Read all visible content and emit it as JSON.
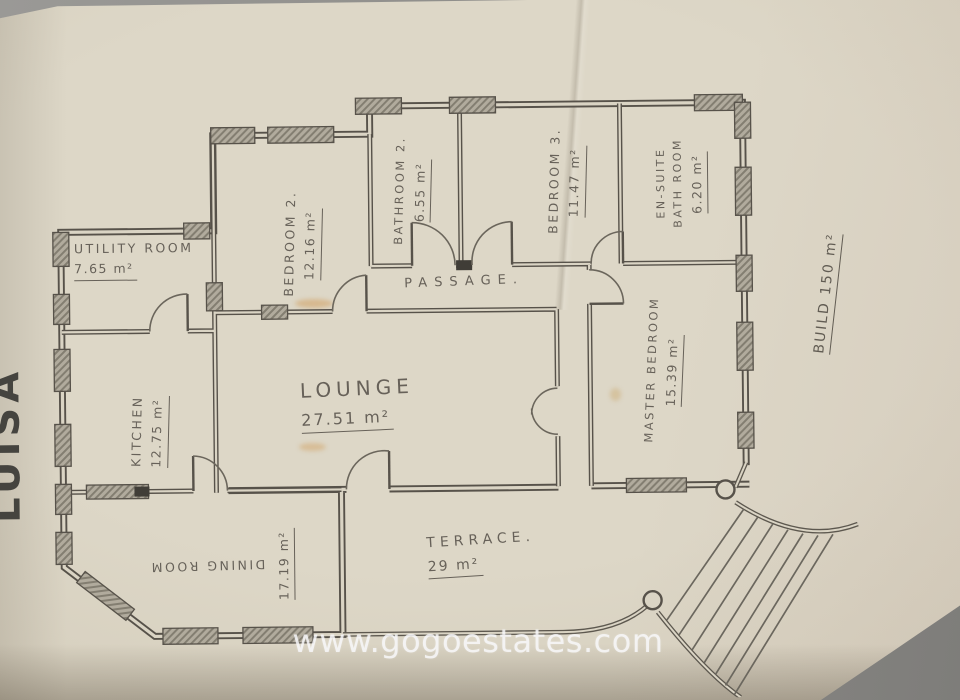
{
  "photo": {
    "watermark_text": "www.gogoestates.com",
    "plan_side_name": "LUISA",
    "total_build_label": "BUILD 150 m²"
  },
  "plan": {
    "rooms": [
      {
        "name": "UTILITY ROOM",
        "area": "7.65 m²"
      },
      {
        "name": "BEDROOM 2.",
        "area": "12.16 m²"
      },
      {
        "name": "BATHROOM 2.",
        "area": "6.55 m²"
      },
      {
        "name": "BEDROOM 3.",
        "area": "11.47 m²"
      },
      {
        "name": "EN-SUITE",
        "name2": "BATH ROOM",
        "area": "6.20 m²"
      },
      {
        "name": "PASSAGE."
      },
      {
        "name": "KITCHEN",
        "area": "12.75 m²"
      },
      {
        "name": "LOUNGE",
        "area": "27.51 m²"
      },
      {
        "name": "MASTER BEDROOM",
        "area": "15.39 m²"
      },
      {
        "name": "DINING ROOM",
        "area": "17.19 m²"
      },
      {
        "name": "TERRACE.",
        "area": "29 m²"
      }
    ]
  },
  "colors": {
    "paper": "#dcd6c6",
    "ink": "#57524a",
    "watermark": "#f5f5f6",
    "backdrop": "#8d8c89"
  }
}
